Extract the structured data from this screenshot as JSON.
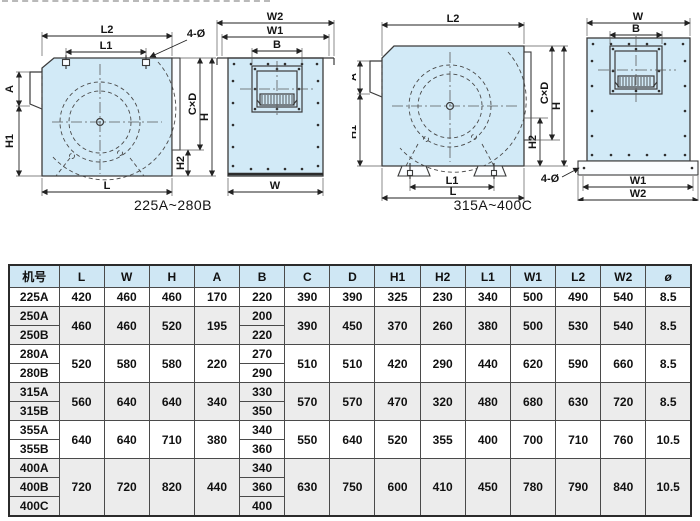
{
  "diagrams": [
    {
      "caption": "225A~280B",
      "side": {
        "l2": "L2",
        "l1": "L1",
        "bolt": "4-Ø",
        "a": "A",
        "h1": "H1",
        "l": "L",
        "cxd": "C×D",
        "h": "H",
        "h2": "H2"
      },
      "front": {
        "w2": "W2",
        "w1": "W1",
        "b": "B",
        "w": "W"
      }
    },
    {
      "caption": "315A~400C",
      "side": {
        "l2": "L2",
        "a": "A",
        "h1": "H1",
        "l1": "L1",
        "l": "L",
        "cxd": "C×D",
        "h": "H",
        "h2": "H2"
      },
      "front": {
        "w": "W",
        "b": "B",
        "w1": "W1",
        "w2": "W2",
        "bolt": "4-Ø"
      }
    }
  ],
  "table": {
    "headers": [
      "机号",
      "L",
      "W",
      "H",
      "A",
      "B",
      "C",
      "D",
      "H1",
      "H2",
      "L1",
      "W1",
      "L2",
      "W2",
      "ø"
    ],
    "groups": [
      {
        "models": [
          "225A"
        ],
        "L": "420",
        "W": "460",
        "H": "460",
        "A": "170",
        "B": [
          "220"
        ],
        "C": "390",
        "D": "390",
        "H1": "325",
        "H2": "230",
        "L1": "340",
        "W1": "500",
        "L2": "490",
        "W2": "540",
        "dia": "8.5"
      },
      {
        "models": [
          "250A",
          "250B"
        ],
        "L": "460",
        "W": "460",
        "H": "520",
        "A": "195",
        "B": [
          "200",
          "220"
        ],
        "C": "390",
        "D": "450",
        "H1": "370",
        "H2": "260",
        "L1": "380",
        "W1": "500",
        "L2": "530",
        "W2": "540",
        "dia": "8.5"
      },
      {
        "models": [
          "280A",
          "280B"
        ],
        "L": "520",
        "W": "580",
        "H": "580",
        "A": "220",
        "B": [
          "270",
          "290"
        ],
        "C": "510",
        "D": "510",
        "H1": "420",
        "H2": "290",
        "L1": "440",
        "W1": "620",
        "L2": "590",
        "W2": "660",
        "dia": "8.5"
      },
      {
        "models": [
          "315A",
          "315B"
        ],
        "L": "560",
        "W": "640",
        "H": "640",
        "A": "340",
        "B": [
          "330",
          "350"
        ],
        "C": "570",
        "D": "570",
        "H1": "470",
        "H2": "320",
        "L1": "480",
        "W1": "680",
        "L2": "630",
        "W2": "720",
        "dia": "8.5"
      },
      {
        "models": [
          "355A",
          "355B"
        ],
        "L": "640",
        "W": "640",
        "H": "710",
        "A": "380",
        "B": [
          "340",
          "360"
        ],
        "C": "550",
        "D": "640",
        "H1": "520",
        "H2": "355",
        "L1": "400",
        "W1": "700",
        "L2": "710",
        "W2": "760",
        "dia": "10.5"
      },
      {
        "models": [
          "400A",
          "400B",
          "400C"
        ],
        "L": "720",
        "W": "720",
        "H": "820",
        "A": "440",
        "B": [
          "340",
          "360",
          "400"
        ],
        "C": "630",
        "D": "750",
        "H1": "600",
        "H2": "410",
        "L1": "450",
        "W1": "780",
        "L2": "790",
        "W2": "840",
        "dia": "10.5"
      }
    ]
  },
  "colors": {
    "header_bg": "#cfe7f4",
    "shaded_row_bg": "#ececec",
    "diagram_fill": "#d2eaf7",
    "table_border": "#2b2b2b"
  }
}
